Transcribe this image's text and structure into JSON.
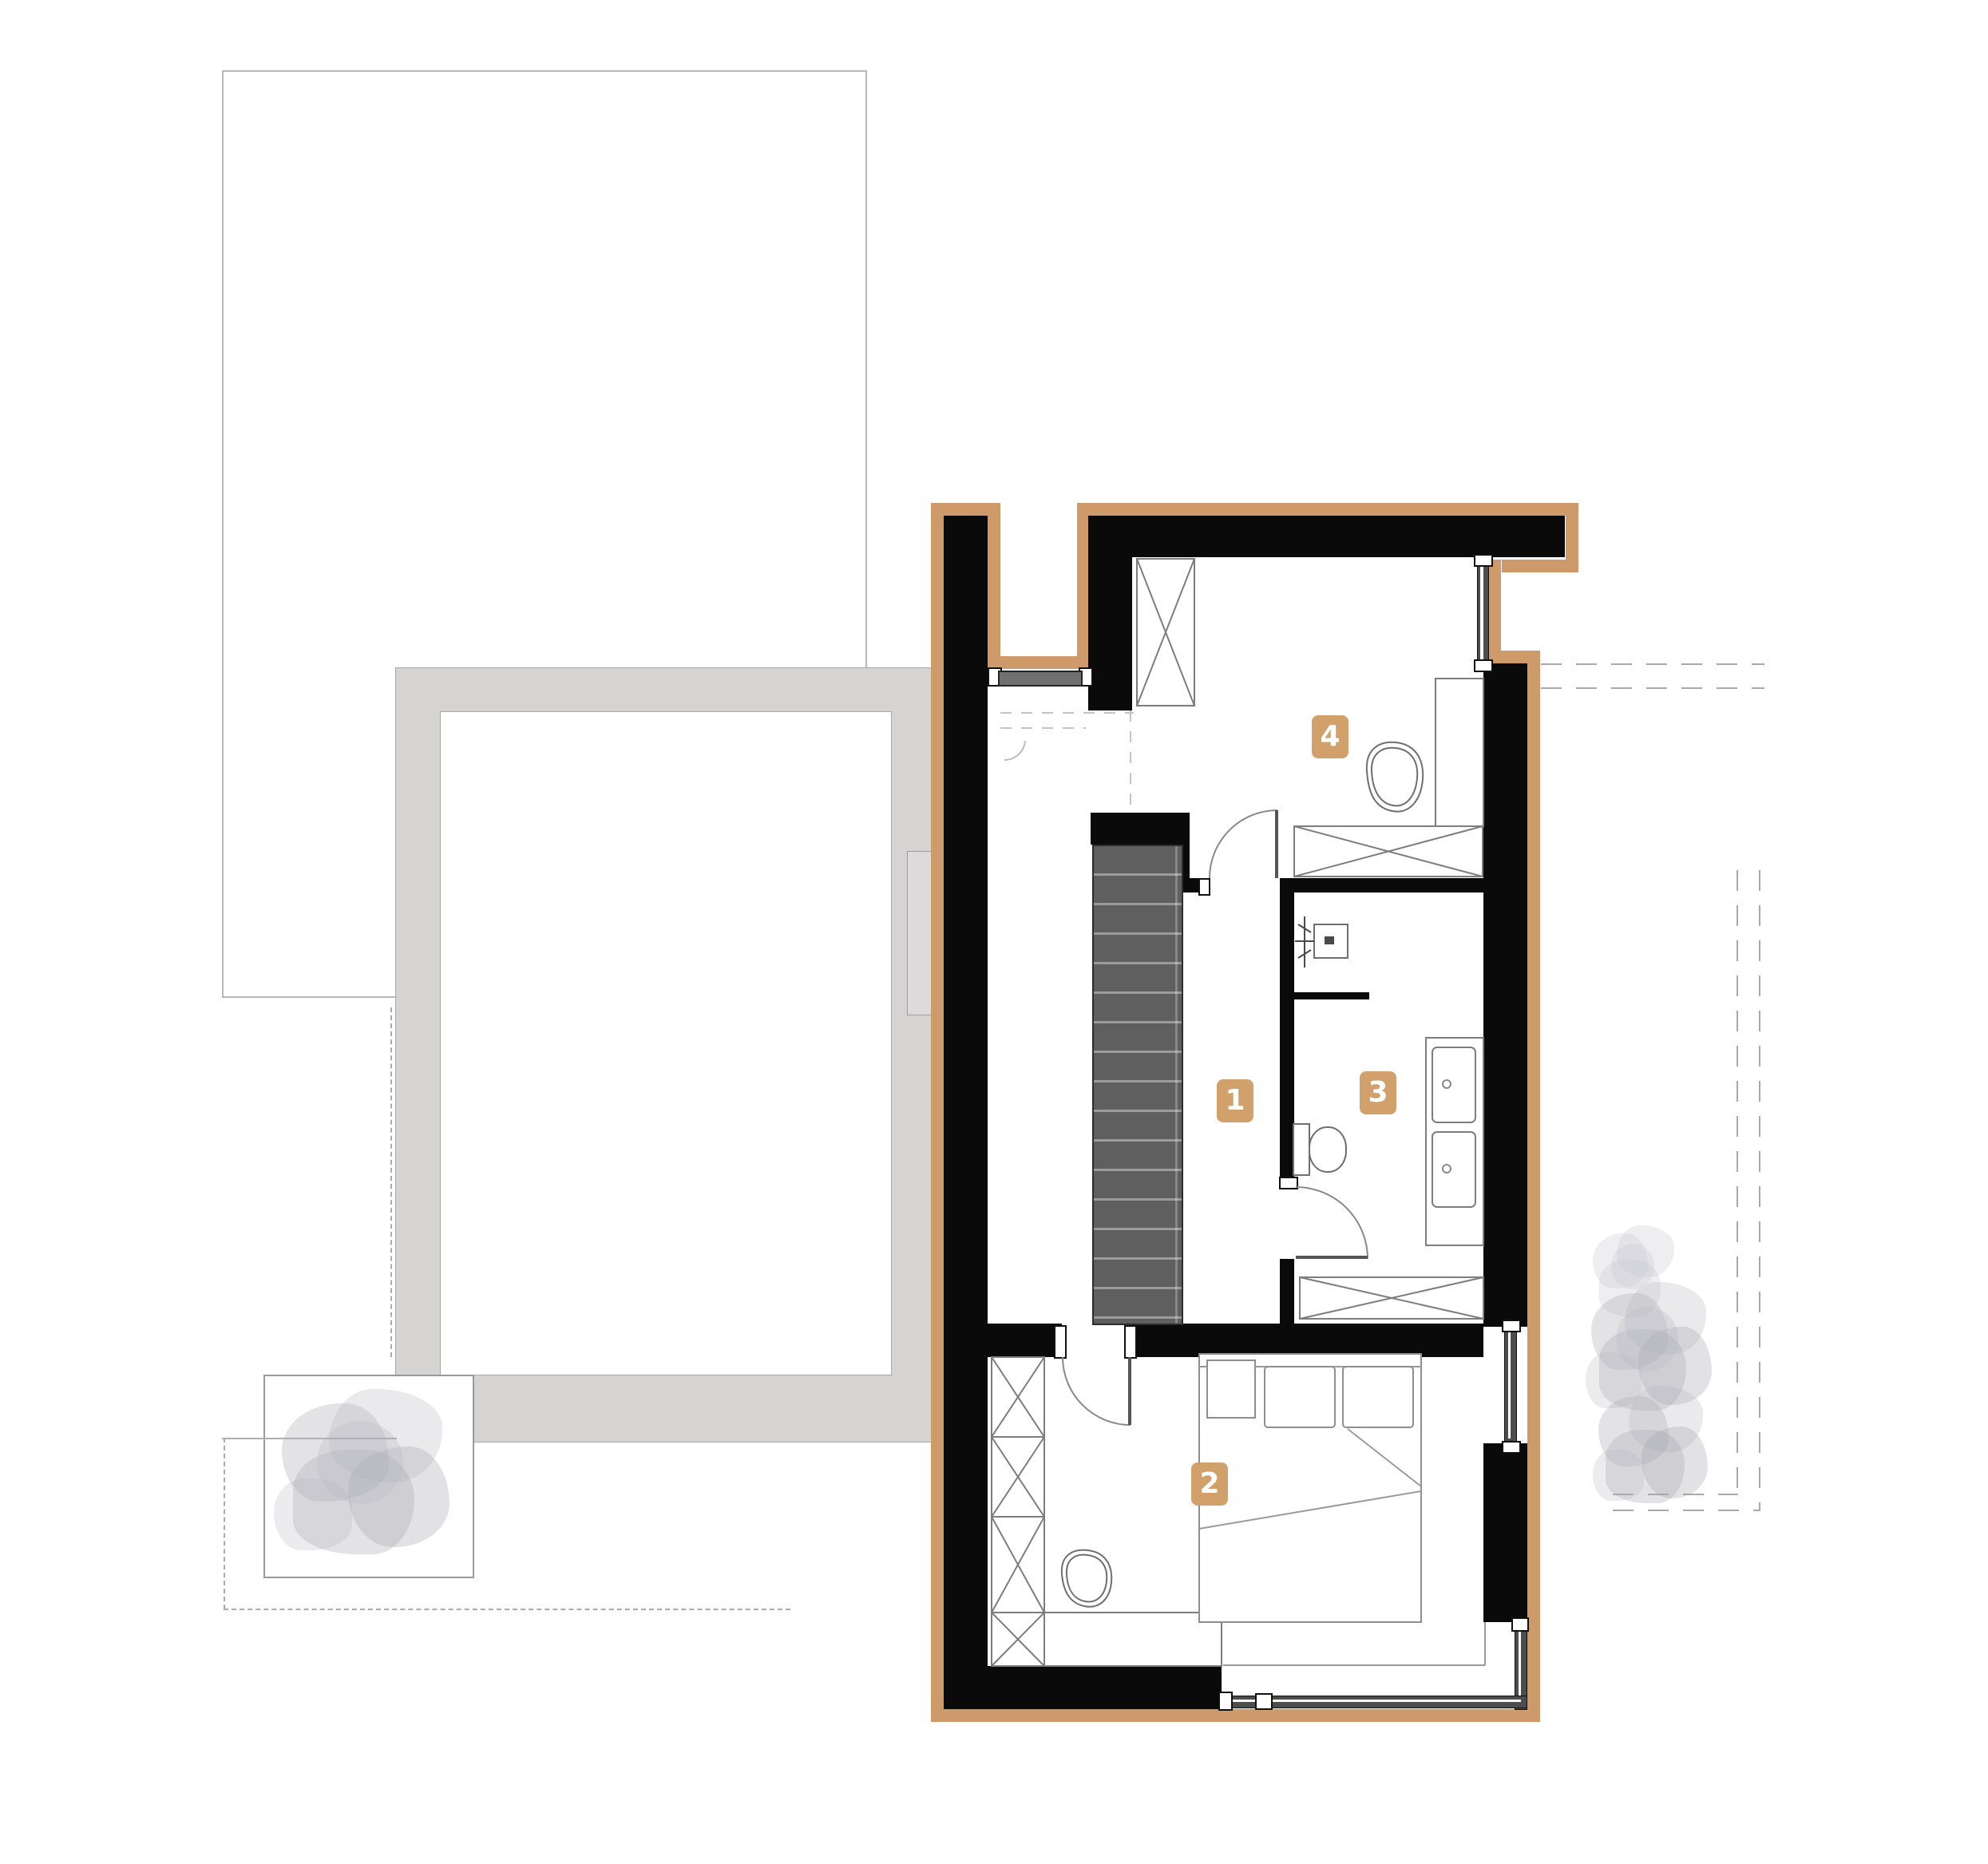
{
  "plan": {
    "type": "architectural floor plan, upper storey",
    "rooms": [
      {
        "number": "1",
        "role": "stair-hall"
      },
      {
        "number": "2",
        "role": "bedroom"
      },
      {
        "number": "3",
        "role": "bathroom"
      },
      {
        "number": "4",
        "role": "room"
      }
    ],
    "fixtures_visible": [
      "staircase",
      "double-bed",
      "pillows",
      "nightstand",
      "wardrobes",
      "desk",
      "vanity-two-sinks",
      "toilet",
      "shower",
      "pouf",
      "planter",
      "trees"
    ],
    "colors": {
      "insulation_accent": "#cf9a69",
      "badge": "#d2a06b",
      "wall": "#0a0a0a",
      "stair_fill": "#5f5f5f",
      "site_gray": "#d6d3d3",
      "line_gray": "#9a9a9a"
    }
  }
}
